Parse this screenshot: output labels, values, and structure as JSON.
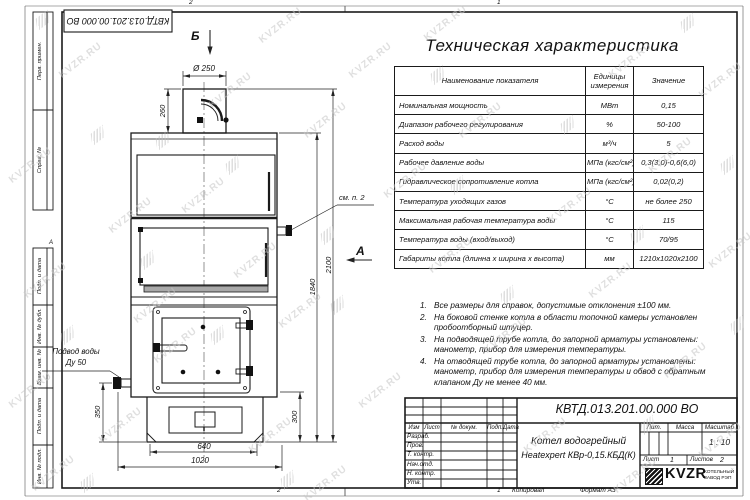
{
  "sheet": {
    "zone_top": [
      "2",
      "1"
    ],
    "zone_bottom": [
      "2",
      "1"
    ],
    "zone_left": "А",
    "copied": "Копировал",
    "format": "Формат А3",
    "doc_number_top": "КВТД.013.201.00.000 ВО",
    "left_columns": [
      "Перв. примен.",
      "Справ. №",
      "Подп. и дата",
      "Инв. № дубл.",
      "Взам. инв. №",
      "Подп. и дата",
      "Инв. № подл."
    ]
  },
  "watermark": {
    "text": "KVZR.RU"
  },
  "spec": {
    "title": "Техническая характеристика",
    "col_name": "Наименование показателя",
    "col_units": "Единицы измерения",
    "col_value": "Значение",
    "rows": [
      {
        "name": "Номинальная мощность",
        "units": "МВт",
        "value": "0,15"
      },
      {
        "name": "Диапазон рабочего регулирования",
        "units": "%",
        "value": "50-100"
      },
      {
        "name": "Расход воды",
        "units": "м³/ч",
        "value": "5"
      },
      {
        "name": "Рабочее давление воды",
        "units": "МПа (кгс/см²)",
        "value": "0,3(3,0)-0,6(6,0)"
      },
      {
        "name": "Гидравлическое сопротивление котла",
        "units": "МПа (кгс/см²)",
        "value": "0,02(0,2)"
      },
      {
        "name": "Температура уходящих газов",
        "units": "°С",
        "value": "не более 250"
      },
      {
        "name": "Максимальная рабочая температура воды",
        "units": "°С",
        "value": "115"
      },
      {
        "name": "Температура воды (вход/выход)",
        "units": "°С",
        "value": "70/95"
      },
      {
        "name": "Габариты котла (длинна х ширина х высота)",
        "units": "мм",
        "value": "1210х1020х2100"
      }
    ]
  },
  "notes": [
    {
      "n": "1.",
      "text": "Все размеры для справок, допустимые отклонения ±100 мм."
    },
    {
      "n": "2.",
      "text": "На боковой стенке котла в области топочной камеры установлен пробоотборный штуцер."
    },
    {
      "n": "3.",
      "text": "На подводящей трубе котла, до запорной арматуры установлены: манометр, прибор для измерения температуры."
    },
    {
      "n": "4.",
      "text": "На отводящей трубе котла, до запорной арматуры установлены: манометр, прибор для измерения температуры и обвод с обратным клапаном Ду не менее 40 мм."
    }
  ],
  "drawing": {
    "dims": {
      "diameter": "Ø 250",
      "chimney_height": "260",
      "total_height": "2100",
      "body_height": "1840",
      "inlet_height": "350",
      "base_height": "300",
      "base_width": "640",
      "total_width": "1020"
    },
    "view_b": "Б",
    "view_a": "А",
    "see_note": "см. п. 2",
    "inlet_line1": "Подвод воды",
    "inlet_line2": "Ду 50"
  },
  "title_block": {
    "doc_number": "КВТД.013.201.00.000 ВО",
    "name_line1": "Котел водогрейный",
    "name_line2": "Heatexpert КВр-0,15.КБД(К)",
    "col_izm": "Изм",
    "col_list": "Лист",
    "col_doc": "№ докум.",
    "col_podp": "Подп.",
    "col_data": "Дата",
    "rows": [
      "Разраб.",
      "Пров.",
      "Т. контр.",
      "Нач.отд.",
      "Н. контр.",
      "Утв."
    ],
    "lit": "Лит.",
    "mass": "Масса",
    "scale_label": "Масштаб",
    "scale": "1 : 10",
    "sheet_label": "Лист",
    "sheet_num": "1",
    "sheets_label": "Листов",
    "sheets_num": "2",
    "brand": "KVZR",
    "brand_line1": "КОТЕЛЬНЫЙ",
    "brand_line2": "ЗАВОД РЭП"
  }
}
